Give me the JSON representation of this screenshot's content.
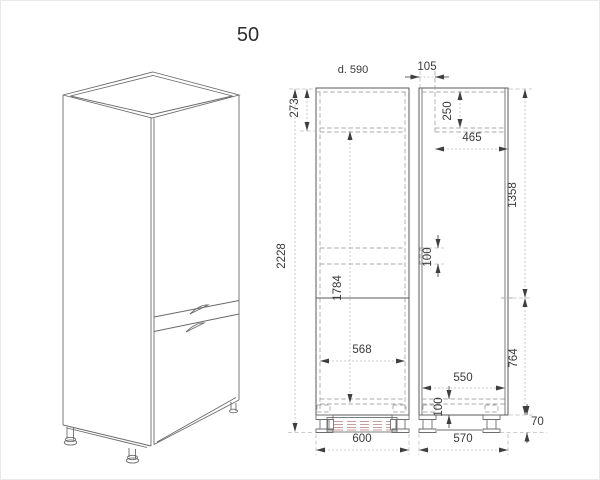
{
  "title": "50",
  "front_view": {
    "depth_note": "d. 590",
    "dim_total_height": "2228",
    "dim_top_section": "273",
    "dim_body_height": "1784",
    "dim_inner_width": "568",
    "dim_width": "600"
  },
  "side_view": {
    "dim_top_offset": "105",
    "dim_top_recess": "250",
    "dim_top_inner_depth": "465",
    "dim_upper_height": "1358",
    "dim_shelf_gap": "100",
    "dim_lower_height": "764",
    "dim_inner_depth": "550",
    "dim_bottom_gap": "100",
    "dim_depth": "570",
    "dim_plinth_height": "70"
  },
  "colors": {
    "line": "#585858",
    "hidden_line": "#a9a9a9",
    "dimension_line": "#bdbdbd",
    "text": "#3a3a3a",
    "plinth_hatch": "#c79e9e"
  }
}
